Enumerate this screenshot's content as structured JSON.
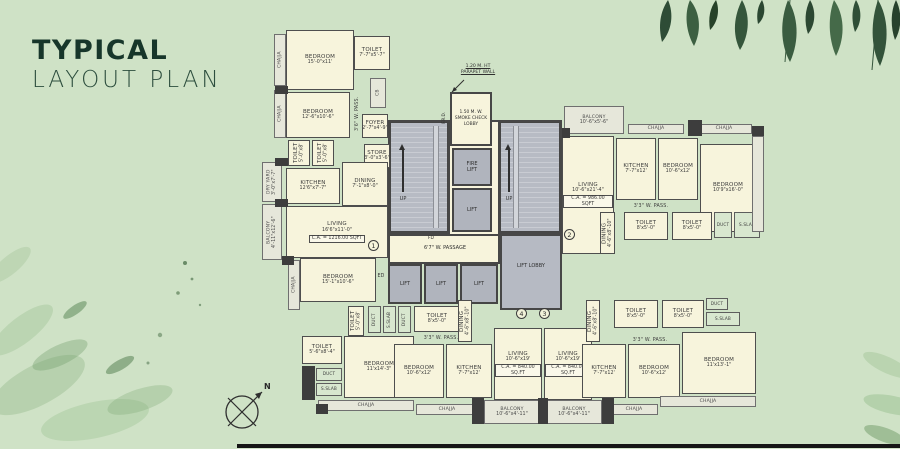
{
  "title": {
    "line1": "TYPICAL",
    "line2": "LAYOUT PLAN"
  },
  "compass": {
    "label": "N"
  },
  "colors": {
    "background": "#cfe2c6",
    "title_text": "#17362a",
    "room_fill": "#f7f4dc",
    "wall": "#474747",
    "stair_fill": "#b6bac3",
    "shaft_fill": "#d8e7cf",
    "leaf_dark": "#2e4c36"
  },
  "plan": {
    "core": {
      "parapet_note": "1.20 M. HT\nPARAPET WALL",
      "smoke_lobby": "1.50 M. W.\nSMOKE CHECK\nLOBBY",
      "frd": "F.R.D.",
      "fire_lift": "FIRE\nLIFT",
      "lift": "LIFT",
      "up": "UP",
      "fd": "FD",
      "ed": "ED",
      "passage": "6'7\" W. PASSAGE",
      "lift_lobby": "LIFT LOBBY",
      "lifts": [
        "LIFT",
        "LIFT",
        "LIFT"
      ]
    },
    "units": [
      {
        "num": "1",
        "x": 368,
        "y": 240
      },
      {
        "num": "2",
        "x": 564,
        "y": 229
      },
      {
        "num": "4",
        "x": 516,
        "y": 308
      },
      {
        "num": "3",
        "x": 539,
        "y": 308
      }
    ],
    "rooms": [
      {
        "n": "chajja-strip",
        "l": "CHAJJA",
        "x": 274,
        "y": 34,
        "w": 12,
        "h": 52,
        "k": "open",
        "v": 1
      },
      {
        "n": "chajja-strip",
        "l": "CHAJJA",
        "x": 274,
        "y": 90,
        "w": 12,
        "h": 48,
        "k": "open",
        "v": 1
      },
      {
        "n": "bedroom",
        "l": "BEDROOM",
        "d": "15'-0\"x11'",
        "x": 286,
        "y": 30,
        "w": 68,
        "h": 60,
        "k": "room"
      },
      {
        "n": "toilet",
        "l": "TOILET",
        "d": "7'-7\"x5'-7\"",
        "x": 354,
        "y": 36,
        "w": 36,
        "h": 34,
        "k": "room"
      },
      {
        "n": "cb-shaft",
        "l": "CB",
        "x": 370,
        "y": 78,
        "w": 16,
        "h": 30,
        "k": "open",
        "v": 1
      },
      {
        "n": "passage",
        "l": "3'6\" W. PASS.",
        "x": 352,
        "y": 90,
        "w": 12,
        "h": 48,
        "k": "text",
        "v": 1
      },
      {
        "n": "bedroom",
        "l": "BEDROOM",
        "d": "12'-6\"x10'-6\"",
        "x": 286,
        "y": 92,
        "w": 64,
        "h": 46,
        "k": "room"
      },
      {
        "n": "foyer",
        "l": "FOYER",
        "d": "2'-7\"x4'-9\"",
        "x": 362,
        "y": 114,
        "w": 26,
        "h": 24,
        "k": "room"
      },
      {
        "n": "toilet",
        "l": "TOILET",
        "d": "5'-0\"x8'",
        "x": 288,
        "y": 140,
        "w": 22,
        "h": 26,
        "k": "room",
        "v": 1
      },
      {
        "n": "toilet",
        "l": "TOILET",
        "d": "5'-0\"x8'",
        "x": 312,
        "y": 140,
        "w": 22,
        "h": 26,
        "k": "room",
        "v": 1
      },
      {
        "n": "store",
        "l": "STORE",
        "d": "3'-0\"x3'-6\"",
        "x": 364,
        "y": 144,
        "w": 26,
        "h": 24,
        "k": "room"
      },
      {
        "n": "dry-yard",
        "l": "DRY YARD",
        "d": "3'-0\"x7'-7\"",
        "x": 262,
        "y": 162,
        "w": 20,
        "h": 40,
        "k": "open",
        "v": 1
      },
      {
        "n": "kitchen",
        "l": "KITCHEN",
        "d": "12'6\"x7'-7\"",
        "x": 286,
        "y": 168,
        "w": 54,
        "h": 36,
        "k": "room"
      },
      {
        "n": "dining",
        "l": "DINING",
        "d": "7'-1\"x8'-0\"",
        "x": 342,
        "y": 162,
        "w": 46,
        "h": 44,
        "k": "room"
      },
      {
        "n": "balcony",
        "l": "BALCONY",
        "d": "4'-11\"x12'-6\"",
        "x": 262,
        "y": 204,
        "w": 20,
        "h": 56,
        "k": "open",
        "v": 1
      },
      {
        "n": "living",
        "l": "LIVING",
        "d": "16'6\"x11'-0\"",
        "ca": "C.A. = 1216.00 SQFT",
        "x": 286,
        "y": 206,
        "w": 102,
        "h": 52,
        "k": "room"
      },
      {
        "n": "chajja-strip",
        "l": "CHAJJA",
        "x": 288,
        "y": 260,
        "w": 12,
        "h": 50,
        "k": "open",
        "v": 1
      },
      {
        "n": "bedroom",
        "l": "BEDROOM",
        "d": "15'-1\"x10'-6\"",
        "x": 300,
        "y": 258,
        "w": 76,
        "h": 44,
        "k": "room"
      },
      {
        "n": "exit-door-label",
        "l": "ED",
        "x": 374,
        "y": 272,
        "w": 14,
        "h": 9,
        "k": "text"
      },
      {
        "n": "toilet",
        "l": "TOILET",
        "d": "5'-0\"x8'",
        "x": 348,
        "y": 306,
        "w": 16,
        "h": 30,
        "k": "room",
        "v": 1
      },
      {
        "n": "duct",
        "l": "DUCT",
        "x": 368,
        "y": 306,
        "w": 13,
        "h": 27,
        "k": "shaft",
        "v": 1
      },
      {
        "n": "s-slab",
        "l": "S.SLAB",
        "x": 383,
        "y": 306,
        "w": 13,
        "h": 27,
        "k": "shaft",
        "v": 1
      },
      {
        "n": "duct",
        "l": "DUCT",
        "x": 398,
        "y": 306,
        "w": 13,
        "h": 27,
        "k": "shaft",
        "v": 1
      },
      {
        "n": "toilet",
        "l": "TOILET",
        "d": "8'x5'-0\"",
        "x": 414,
        "y": 306,
        "w": 46,
        "h": 26,
        "k": "room"
      },
      {
        "n": "passage",
        "l": "3'3\" W. PASS.",
        "x": 410,
        "y": 334,
        "w": 62,
        "h": 10,
        "k": "text"
      },
      {
        "n": "toilet",
        "l": "TOILET",
        "d": "5'-6\"x8'-4\"",
        "x": 302,
        "y": 336,
        "w": 40,
        "h": 28,
        "k": "room"
      },
      {
        "n": "duct",
        "l": "DUCT",
        "x": 316,
        "y": 368,
        "w": 26,
        "h": 13,
        "k": "shaft"
      },
      {
        "n": "s-slab",
        "l": "S.SLAB",
        "x": 316,
        "y": 383,
        "w": 26,
        "h": 13,
        "k": "shaft"
      },
      {
        "n": "bedroom",
        "l": "BEDROOM",
        "d": "11'x14'-3\"",
        "x": 344,
        "y": 336,
        "w": 70,
        "h": 62,
        "k": "room"
      },
      {
        "n": "chajja-strip",
        "l": "CHAJJA",
        "x": 318,
        "y": 400,
        "w": 96,
        "h": 11,
        "k": "open"
      },
      {
        "n": "chajja-strip",
        "l": "CHAJJA",
        "x": 416,
        "y": 404,
        "w": 62,
        "h": 11,
        "k": "open"
      },
      {
        "n": "dining",
        "l": "DINING",
        "d": "4'-6\"x8'-10\"",
        "x": 458,
        "y": 300,
        "w": 14,
        "h": 42,
        "k": "room",
        "v": 1
      },
      {
        "n": "bedroom",
        "l": "BEDROOM",
        "d": "10'-6\"x12'",
        "x": 394,
        "y": 344,
        "w": 50,
        "h": 54,
        "k": "room"
      },
      {
        "n": "kitchen",
        "l": "KITCHEN",
        "d": "7'-7\"x12'",
        "x": 446,
        "y": 344,
        "w": 46,
        "h": 54,
        "k": "room"
      },
      {
        "n": "living",
        "l": "LIVING",
        "d": "10'-6\"x19'",
        "ca": "C.A. = 840.00 SQ.FT",
        "x": 494,
        "y": 328,
        "w": 48,
        "h": 72,
        "k": "room"
      },
      {
        "n": "balcony",
        "l": "BALCONY",
        "d": "10'-6\"x4'-11\"",
        "x": 484,
        "y": 400,
        "w": 56,
        "h": 24,
        "k": "open"
      },
      {
        "n": "living",
        "l": "LIVING",
        "d": "10'-6\"x19'",
        "ca": "C.A. = 840.00 SQ.FT",
        "x": 544,
        "y": 328,
        "w": 48,
        "h": 72,
        "k": "room"
      },
      {
        "n": "balcony",
        "l": "BALCONY",
        "d": "10'-6\"x4'-11\"",
        "x": 546,
        "y": 400,
        "w": 56,
        "h": 24,
        "k": "open"
      },
      {
        "n": "dining",
        "l": "DINING",
        "d": "4'-6\"x8'-10\"",
        "x": 586,
        "y": 300,
        "w": 14,
        "h": 42,
        "k": "room",
        "v": 1
      },
      {
        "n": "toilet",
        "l": "TOILET",
        "d": "8'x5'-0\"",
        "x": 614,
        "y": 300,
        "w": 44,
        "h": 28,
        "k": "room"
      },
      {
        "n": "toilet",
        "l": "TOILET",
        "d": "8'x5'-0\"",
        "x": 662,
        "y": 300,
        "w": 42,
        "h": 28,
        "k": "room"
      },
      {
        "n": "duct",
        "l": "DUCT",
        "x": 706,
        "y": 298,
        "w": 22,
        "h": 12,
        "k": "shaft"
      },
      {
        "n": "s-slab",
        "l": "S.SLAB",
        "x": 706,
        "y": 312,
        "w": 34,
        "h": 14,
        "k": "shaft"
      },
      {
        "n": "passage",
        "l": "3'3\" W. PASS.",
        "x": 616,
        "y": 336,
        "w": 68,
        "h": 10,
        "k": "text"
      },
      {
        "n": "kitchen",
        "l": "KITCHEN",
        "d": "7'-7\"x12'",
        "x": 582,
        "y": 344,
        "w": 44,
        "h": 54,
        "k": "room"
      },
      {
        "n": "bedroom",
        "l": "BEDROOM",
        "d": "10'-6\"x12'",
        "x": 628,
        "y": 344,
        "w": 52,
        "h": 54,
        "k": "room"
      },
      {
        "n": "bedroom",
        "l": "BEDROOM",
        "d": "11'x13'-1\"",
        "x": 682,
        "y": 332,
        "w": 74,
        "h": 62,
        "k": "room"
      },
      {
        "n": "chajja-strip",
        "l": "CHAJJA",
        "x": 610,
        "y": 404,
        "w": 48,
        "h": 11,
        "k": "open"
      },
      {
        "n": "chajja-strip",
        "l": "CHAJJA",
        "x": 660,
        "y": 396,
        "w": 96,
        "h": 11,
        "k": "open"
      },
      {
        "n": "balcony",
        "l": "BALCONY",
        "d": "10'-6\"x5'-6\"",
        "x": 564,
        "y": 106,
        "w": 60,
        "h": 28,
        "k": "open"
      },
      {
        "n": "chajja-strip",
        "l": "CHAJJA",
        "x": 628,
        "y": 124,
        "w": 56,
        "h": 10,
        "k": "open"
      },
      {
        "n": "chajja-strip",
        "l": "CHAJJA",
        "x": 696,
        "y": 124,
        "w": 56,
        "h": 10,
        "k": "open"
      },
      {
        "n": "living",
        "l": "LIVING",
        "d": "10'-6\"x21'-4\"",
        "ca": "C.A. = 986.00 SQFT",
        "x": 562,
        "y": 136,
        "w": 52,
        "h": 118,
        "k": "room"
      },
      {
        "n": "kitchen",
        "l": "KITCHEN",
        "d": "7'-7\"x12'",
        "x": 616,
        "y": 138,
        "w": 40,
        "h": 62,
        "k": "room"
      },
      {
        "n": "bedroom",
        "l": "BEDROOM",
        "d": "10'-6\"x12'",
        "x": 658,
        "y": 138,
        "w": 40,
        "h": 62,
        "k": "room"
      },
      {
        "n": "bedroom",
        "l": "BEDROOM",
        "d": "10'9\"x16'-0\"",
        "x": 700,
        "y": 144,
        "w": 56,
        "h": 88,
        "k": "room"
      },
      {
        "n": "passage",
        "l": "3'3\" W. PASS.",
        "x": 616,
        "y": 202,
        "w": 70,
        "h": 10,
        "k": "text"
      },
      {
        "n": "dining",
        "l": "DINING",
        "d": "4'-6\"x8'-10\"",
        "x": 600,
        "y": 212,
        "w": 15,
        "h": 42,
        "k": "room",
        "v": 1
      },
      {
        "n": "toilet",
        "l": "TOILET",
        "d": "8'x5'-0\"",
        "x": 624,
        "y": 212,
        "w": 44,
        "h": 28,
        "k": "room"
      },
      {
        "n": "toilet",
        "l": "TOILET",
        "d": "8'x5'-0\"",
        "x": 672,
        "y": 212,
        "w": 40,
        "h": 28,
        "k": "room"
      },
      {
        "n": "duct",
        "l": "DUCT",
        "x": 714,
        "y": 212,
        "w": 18,
        "h": 26,
        "k": "shaft"
      },
      {
        "n": "s-slab",
        "l": "S.SLAB",
        "x": 734,
        "y": 212,
        "w": 26,
        "h": 26,
        "k": "shaft"
      },
      {
        "n": "side-strip",
        "x": 752,
        "y": 136,
        "w": 12,
        "h": 96,
        "k": "open"
      }
    ],
    "piers": [
      [
        275,
        86,
        13,
        8
      ],
      [
        275,
        158,
        13,
        8
      ],
      [
        275,
        199,
        13,
        8
      ],
      [
        282,
        256,
        12,
        9
      ],
      [
        302,
        366,
        13,
        34
      ],
      [
        688,
        120,
        14,
        16
      ],
      [
        562,
        128,
        8,
        10
      ],
      [
        752,
        126,
        12,
        10
      ],
      [
        472,
        398,
        12,
        26
      ],
      [
        538,
        398,
        10,
        26
      ],
      [
        602,
        398,
        12,
        26
      ],
      [
        316,
        404,
        12,
        10
      ]
    ]
  }
}
